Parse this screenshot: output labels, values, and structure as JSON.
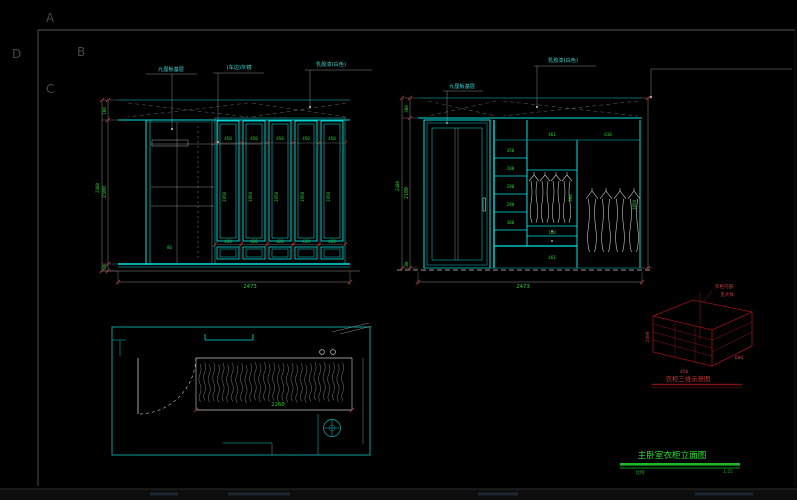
{
  "colors": {
    "background": "#000000",
    "line_primary": "#00e2e2",
    "line_secondary": "#0c8d8d",
    "dimension_text": "#27cf2f",
    "annotation_red": "#9b1216",
    "detail_white": "#c9c9c9",
    "title_green": "#1db824"
  },
  "drawing": {
    "corner_letters": {
      "a": "A",
      "b": "B",
      "c": "C",
      "d": "D"
    },
    "left_elevation": {
      "callout_1": "九厘板基层",
      "callout_2": "(车边)灰镜",
      "callout_3": "乳胶漆(白色)",
      "dim_top": "100",
      "dim_mid": "2300",
      "dim_bottom_seg": "80",
      "dim_total": "2480",
      "dim_width": "2473",
      "door_height": "1950",
      "side_dim": "86",
      "door_top_dims": [
        "450",
        "450",
        "450",
        "450",
        "450"
      ],
      "door_bottom_dims": [
        "420",
        "420",
        "420",
        "420",
        "420"
      ]
    },
    "right_elevation": {
      "callout_1": "乳胶漆(白色)",
      "callout_2": "九厘板基层",
      "dim_top": "300",
      "dim_mid": "2100",
      "dim_bottom_seg": "80",
      "dim_total": "2480",
      "dim_width": "2473",
      "inner_dims": {
        "a1": "350",
        "a2": "280",
        "a3": "280",
        "a4": "280",
        "a5": "300",
        "b_top": "461",
        "c_top": "610",
        "b_mid": "900",
        "b_drawer": "180",
        "b_bottom": "461",
        "c_side": "1050"
      }
    },
    "plan_view": {
      "dim_width": "2260"
    },
    "sketch_3d": {
      "note_1": "衣柜内部",
      "note_2": "见大样",
      "caption": "衣柜三维示意图",
      "dims": [
        "2400",
        "450",
        "600"
      ]
    },
    "title_block": {
      "title": "主卧室衣柜立面图",
      "scale_label": "比例",
      "scale_value": "1:25"
    }
  }
}
